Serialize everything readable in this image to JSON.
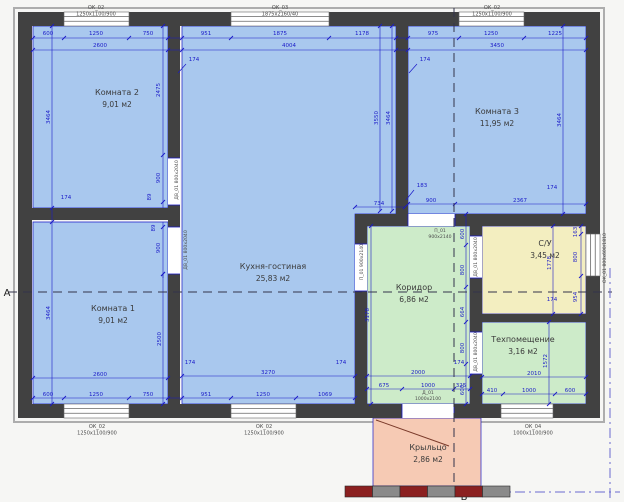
{
  "plan": {
    "colors": {
      "bg": "#f6f6f4",
      "wall": "#414141",
      "wall_outline": "#adadad",
      "dim": "#1a1ac8",
      "room_text": "#3a3a3a",
      "label_text": "#4b4b4b",
      "blue_room": "#a9c8ee",
      "green_room": "#cdebc9",
      "yellow_room": "#f3eec0",
      "pink_room": "#f6cab4",
      "steps_red": "#8b2020",
      "steps_gray": "#8a8a8a",
      "axis": "#33334a"
    },
    "rooms": [
      {
        "id": "komnata-2",
        "name": "Комната 2",
        "area": "9,01 м2",
        "fill": "blue_room",
        "poly": [
          [
            33,
            26
          ],
          [
            168,
            26
          ],
          [
            168,
            208
          ],
          [
            33,
            208
          ]
        ],
        "label": [
          117,
          95
        ]
      },
      {
        "id": "komnata-1",
        "name": "Комната 1",
        "area": "9,01 м2",
        "fill": "blue_room",
        "poly": [
          [
            33,
            222
          ],
          [
            168,
            222
          ],
          [
            168,
            404
          ],
          [
            33,
            404
          ]
        ],
        "label": [
          113,
          311
        ]
      },
      {
        "id": "kuhnya-gostinaya",
        "name": "Кухня-гостиная",
        "area": "25,83 м2",
        "fill": "blue_room",
        "poly": [
          [
            182,
            26
          ],
          [
            396,
            26
          ],
          [
            396,
            214
          ],
          [
            355,
            214
          ],
          [
            355,
            404
          ],
          [
            182,
            404
          ]
        ],
        "label": [
          273,
          269
        ]
      },
      {
        "id": "komnata-3",
        "name": "Комната 3",
        "area": "11,95 м2",
        "fill": "blue_room",
        "poly": [
          [
            408,
            26
          ],
          [
            586,
            26
          ],
          [
            586,
            214
          ],
          [
            408,
            214
          ]
        ],
        "label": [
          497,
          114
        ]
      },
      {
        "id": "koridor",
        "name": "Коридор",
        "area": "6,86 м2",
        "fill": "green_room",
        "poly": [
          [
            367,
            226
          ],
          [
            470,
            226
          ],
          [
            470,
            404
          ],
          [
            367,
            404
          ]
        ],
        "label": [
          414,
          290
        ]
      },
      {
        "id": "su",
        "name": "С/У",
        "area": "3,45 м2",
        "fill": "yellow_room",
        "poly": [
          [
            482,
            226
          ],
          [
            586,
            226
          ],
          [
            586,
            314
          ],
          [
            482,
            314
          ]
        ],
        "label": [
          545,
          246
        ]
      },
      {
        "id": "tehpomeshchenie",
        "name": "Техпомещение",
        "area": "3,16 м2",
        "fill": "green_room",
        "poly": [
          [
            482,
            322
          ],
          [
            586,
            322
          ],
          [
            586,
            404
          ],
          [
            482,
            404
          ]
        ],
        "label": [
          523,
          342
        ]
      },
      {
        "id": "krylco",
        "name": "Крыльцо",
        "area": "2,86 м2",
        "fill": "pink_room",
        "poly": [
          [
            373,
            418
          ],
          [
            481,
            418
          ],
          [
            481,
            486
          ],
          [
            373,
            486
          ]
        ],
        "label": [
          428,
          450
        ]
      }
    ],
    "walls": [
      [
        18,
        12,
        600,
        26
      ],
      [
        18,
        404,
        600,
        418
      ],
      [
        18,
        12,
        32,
        418
      ],
      [
        586,
        12,
        600,
        418
      ],
      [
        168,
        26,
        180,
        404
      ],
      [
        26,
        208,
        180,
        220
      ],
      [
        396,
        26,
        408,
        214
      ],
      [
        355,
        214,
        586,
        226
      ],
      [
        355,
        214,
        367,
        404
      ],
      [
        470,
        214,
        482,
        404
      ],
      [
        470,
        314,
        586,
        322
      ]
    ],
    "windows": [
      {
        "rect": [
          64,
          12,
          129,
          26
        ],
        "o": "h"
      },
      {
        "rect": [
          231,
          12,
          329,
          26
        ],
        "o": "h"
      },
      {
        "rect": [
          459,
          12,
          524,
          26
        ],
        "o": "h"
      },
      {
        "rect": [
          64,
          404,
          129,
          418
        ],
        "o": "h"
      },
      {
        "rect": [
          231,
          404,
          296,
          418
        ],
        "o": "h"
      },
      {
        "rect": [
          501,
          404,
          553,
          418
        ],
        "o": "h"
      },
      {
        "rect": [
          586,
          234,
          600,
          276
        ],
        "o": "v"
      }
    ],
    "door_openings": [
      {
        "rect": [
          168,
          158,
          180,
          205
        ],
        "o": "v"
      },
      {
        "rect": [
          168,
          227,
          180,
          274
        ],
        "o": "v"
      },
      {
        "rect": [
          355,
          244,
          367,
          291
        ],
        "o": "v"
      },
      {
        "rect": [
          470,
          236,
          482,
          278
        ],
        "o": "v"
      },
      {
        "rect": [
          470,
          332,
          482,
          374
        ],
        "o": "v"
      },
      {
        "rect": [
          408,
          214,
          455,
          226
        ],
        "o": "h"
      },
      {
        "rect": [
          402,
          404,
          454,
          418
        ],
        "o": "h"
      }
    ],
    "dim_lines_h": [
      {
        "y": 38,
        "x1": 33,
        "x2": 586,
        "ticks": [
          33,
          64,
          129,
          168,
          182,
          231,
          329,
          396,
          408,
          459,
          524,
          586
        ]
      },
      {
        "y": 50,
        "x1": 33,
        "x2": 586,
        "ticks": [
          33,
          168,
          182,
          396,
          408,
          586
        ]
      },
      {
        "y": 398,
        "x1": 33,
        "x2": 355,
        "ticks": [
          33,
          64,
          129,
          168,
          182,
          231,
          296,
          355
        ]
      },
      {
        "y": 378,
        "x1": 33,
        "x2": 168,
        "ticks": [
          33,
          168
        ]
      },
      {
        "y": 376,
        "x1": 182,
        "x2": 355,
        "ticks": [
          182,
          355
        ]
      },
      {
        "y": 389,
        "x1": 367,
        "x2": 470,
        "ticks": [
          367,
          402,
          454,
          470
        ]
      },
      {
        "y": 376,
        "x1": 367,
        "x2": 470,
        "ticks": [
          367,
          470
        ]
      },
      {
        "y": 394,
        "x1": 482,
        "x2": 586,
        "ticks": [
          482,
          503,
          555,
          586
        ]
      },
      {
        "y": 377,
        "x1": 482,
        "x2": 586,
        "ticks": [
          482,
          586
        ]
      },
      {
        "y": 204,
        "x1": 408,
        "x2": 586,
        "ticks": [
          408,
          455,
          586
        ]
      },
      {
        "y": 207,
        "x1": 355,
        "x2": 405,
        "ticks": [
          355,
          405
        ]
      }
    ],
    "dim_lines_v": [
      {
        "x": 52,
        "y1": 26,
        "y2": 404,
        "ticks": [
          26,
          208,
          222,
          404
        ]
      },
      {
        "x": 163,
        "y1": 26,
        "y2": 208,
        "ticks": [
          26,
          155,
          202
        ]
      },
      {
        "x": 163,
        "y1": 222,
        "y2": 278,
        "ticks": [
          227,
          274
        ]
      },
      {
        "x": 163,
        "y1": 274,
        "y2": 404,
        "ticks": [
          274,
          404
        ]
      },
      {
        "x": 380,
        "y1": 26,
        "y2": 211,
        "ticks": [
          26,
          211
        ]
      },
      {
        "x": 392,
        "y1": 26,
        "y2": 211,
        "ticks": [
          26,
          211
        ]
      },
      {
        "x": 563,
        "y1": 26,
        "y2": 214,
        "ticks": [
          26,
          214
        ]
      },
      {
        "x": 371,
        "y1": 226,
        "y2": 404,
        "ticks": [
          226,
          404
        ]
      },
      {
        "x": 466,
        "y1": 214,
        "y2": 404,
        "ticks": [
          214,
          245,
          287,
          322,
          364,
          404
        ]
      },
      {
        "x": 553,
        "y1": 226,
        "y2": 314,
        "ticks": [
          226,
          314
        ]
      },
      {
        "x": 581,
        "y1": 226,
        "y2": 314,
        "ticks": [
          226,
          234,
          276,
          314
        ]
      },
      {
        "x": 549,
        "y1": 322,
        "y2": 404,
        "ticks": [
          322,
          404
        ]
      }
    ],
    "dim_texts": [
      {
        "t": "600",
        "x": 48,
        "y": 35
      },
      {
        "t": "1250",
        "x": 96,
        "y": 35
      },
      {
        "t": "750",
        "x": 148,
        "y": 35
      },
      {
        "t": "951",
        "x": 206,
        "y": 35
      },
      {
        "t": "1875",
        "x": 280,
        "y": 35
      },
      {
        "t": "1178",
        "x": 362,
        "y": 35
      },
      {
        "t": "975",
        "x": 433,
        "y": 35
      },
      {
        "t": "1250",
        "x": 491,
        "y": 35
      },
      {
        "t": "1225",
        "x": 555,
        "y": 35
      },
      {
        "t": "2600",
        "x": 100,
        "y": 47
      },
      {
        "t": "4004",
        "x": 289,
        "y": 47
      },
      {
        "t": "3450",
        "x": 497,
        "y": 47
      },
      {
        "t": "600",
        "x": 48,
        "y": 396
      },
      {
        "t": "1250",
        "x": 96,
        "y": 396
      },
      {
        "t": "750",
        "x": 148,
        "y": 396
      },
      {
        "t": "951",
        "x": 206,
        "y": 396
      },
      {
        "t": "1250",
        "x": 263,
        "y": 396
      },
      {
        "t": "1069",
        "x": 325,
        "y": 396
      },
      {
        "t": "2600",
        "x": 100,
        "y": 376
      },
      {
        "t": "3270",
        "x": 268,
        "y": 374
      },
      {
        "t": "2000",
        "x": 418,
        "y": 374
      },
      {
        "t": "675",
        "x": 384,
        "y": 387
      },
      {
        "t": "1000",
        "x": 428,
        "y": 387
      },
      {
        "t": "325",
        "x": 461,
        "y": 387
      },
      {
        "t": "2010",
        "x": 534,
        "y": 375
      },
      {
        "t": "410",
        "x": 492,
        "y": 392
      },
      {
        "t": "1000",
        "x": 529,
        "y": 392
      },
      {
        "t": "600",
        "x": 570,
        "y": 392
      },
      {
        "t": "900",
        "x": 431,
        "y": 202
      },
      {
        "t": "2367",
        "x": 520,
        "y": 202
      },
      {
        "t": "734",
        "x": 379,
        "y": 205
      },
      {
        "t": "3464",
        "x": 50,
        "y": 117,
        "r": -90
      },
      {
        "t": "3464",
        "x": 50,
        "y": 313,
        "r": -90
      },
      {
        "t": "2475",
        "x": 160,
        "y": 90,
        "r": -90
      },
      {
        "t": "900",
        "x": 160,
        "y": 178,
        "r": -90
      },
      {
        "t": "89",
        "x": 151,
        "y": 197,
        "r": -90
      },
      {
        "t": "89",
        "x": 155,
        "y": 228,
        "r": -90
      },
      {
        "t": "900",
        "x": 160,
        "y": 248,
        "r": -90
      },
      {
        "t": "2500",
        "x": 161,
        "y": 339,
        "r": -90
      },
      {
        "t": "3550",
        "x": 378,
        "y": 118,
        "r": -90
      },
      {
        "t": "3464",
        "x": 390,
        "y": 118,
        "r": -90
      },
      {
        "t": "3464",
        "x": 561,
        "y": 120,
        "r": -90
      },
      {
        "t": "3178",
        "x": 369,
        "y": 315,
        "r": -90
      },
      {
        "t": "600",
        "x": 464,
        "y": 234,
        "r": -90
      },
      {
        "t": "800",
        "x": 464,
        "y": 270,
        "r": -90
      },
      {
        "t": "664",
        "x": 464,
        "y": 312,
        "r": -90
      },
      {
        "t": "800",
        "x": 464,
        "y": 348,
        "r": -90
      },
      {
        "t": "600",
        "x": 464,
        "y": 390,
        "r": -90
      },
      {
        "t": "1778",
        "x": 551,
        "y": 263,
        "r": -90
      },
      {
        "t": "163",
        "x": 577,
        "y": 232,
        "r": -90
      },
      {
        "t": "800",
        "x": 577,
        "y": 257,
        "r": -90
      },
      {
        "t": "954",
        "x": 577,
        "y": 297,
        "r": -90
      },
      {
        "t": "1572",
        "x": 547,
        "y": 361,
        "r": -90
      }
    ],
    "annotations": [
      {
        "t": "174",
        "x": 194,
        "y": 61,
        "leader": [
          186,
          64,
          178,
          73
        ]
      },
      {
        "t": "174",
        "x": 425,
        "y": 61,
        "leader": [
          417,
          64,
          409,
          73
        ]
      },
      {
        "t": "174",
        "x": 66,
        "y": 199
      },
      {
        "t": "174",
        "x": 190,
        "y": 364
      },
      {
        "t": "174",
        "x": 341,
        "y": 364
      },
      {
        "t": "174",
        "x": 459,
        "y": 364
      },
      {
        "t": "174",
        "x": 552,
        "y": 189
      },
      {
        "t": "174",
        "x": 552,
        "y": 301
      },
      {
        "t": "183",
        "x": 422,
        "y": 187,
        "leader": [
          414,
          190,
          406,
          200
        ]
      }
    ],
    "window_labels": [
      {
        "l1": "ОК_02",
        "l2": "1250х1100/900",
        "x": 96,
        "y": 5
      },
      {
        "l1": "ОК_03",
        "l2": "1875х2160/40",
        "x": 280,
        "y": 5
      },
      {
        "l1": "ОК_02",
        "l2": "1250х1100/900",
        "x": 492,
        "y": 5
      },
      {
        "l1": "ОК_02",
        "l2": "1250х1100/900",
        "x": 97,
        "y": 424
      },
      {
        "l1": "ОК_02",
        "l2": "1250х1100/900",
        "x": 264,
        "y": 424
      },
      {
        "l1": "ОК_04",
        "l2": "1000х1100/900",
        "x": 533,
        "y": 424
      }
    ],
    "door_labels_v": [
      {
        "t": "ДВ_01 800х2040",
        "x": 178,
        "y": 180
      },
      {
        "t": "ДВ_01 800х2040",
        "x": 187,
        "y": 250
      },
      {
        "t": "П_01 900х2140",
        "x": 363,
        "y": 262
      },
      {
        "t": "ДВ_01 800х2040",
        "x": 477,
        "y": 257
      },
      {
        "t": "ДВ_01 800х2040",
        "x": 477,
        "y": 352
      },
      {
        "t": "ОК_01 800х600/1810",
        "x": 606,
        "y": 258
      }
    ],
    "door_labels_h": [
      {
        "l1": "П_01",
        "l2": "900х2140",
        "x": 440,
        "y": 232
      },
      {
        "l1": "Д_01",
        "l2": "1000х2100",
        "x": 428,
        "y": 394
      }
    ],
    "axes": {
      "dashed_h": {
        "y": 292,
        "x1": 8,
        "x2": 612
      },
      "dashed_v": {
        "x": 454,
        "y1": 8,
        "y2": 500
      },
      "dashdot_v": {
        "x": 610,
        "y1": 268,
        "y2": 500
      },
      "dashdot_h": {
        "y": 492,
        "x1": 455,
        "x2": 620
      },
      "letter_left": "А",
      "letter_left_pos": [
        3,
        296
      ],
      "letter_bottom": "Б",
      "letter_bottom_pos": [
        460,
        500
      ]
    },
    "porch": {
      "diagonal": [
        376,
        420,
        449,
        446
      ],
      "steps_rect": [
        345,
        486,
        510,
        497
      ]
    }
  }
}
